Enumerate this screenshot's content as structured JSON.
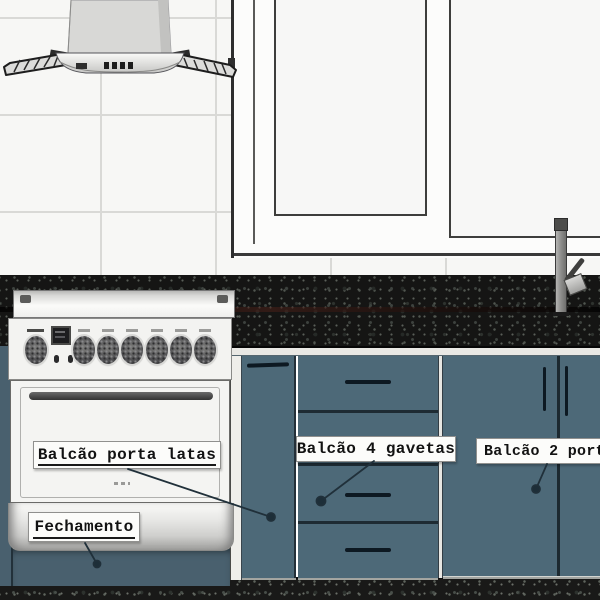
{
  "annotations": {
    "porta_latas": {
      "label": "Balcão porta latas"
    },
    "quatro_gavetas": {
      "label": "Balcão 4 gavetas"
    },
    "duas_portas": {
      "label": "Balcão 2 port"
    },
    "fechamento": {
      "label": "Fechamento"
    }
  },
  "colors": {
    "cabinet_blue": "#4d6978",
    "cabinet_edge": "#1e2b33",
    "handle_dark": "#0d1922",
    "fechamento_blue": "#49606e",
    "granite_base": "#151514",
    "tile_white": "#f7f7f5",
    "grout_gray": "#d9d9d6",
    "window_frame_white": "#fcfcfb",
    "outline_dark": "#3a3a3a",
    "stove_white": "#f3f3f1",
    "label_bg": "#fcfcfa",
    "label_border": "#90908e",
    "label_text": "#121212",
    "leader_dark": "#20303a"
  }
}
